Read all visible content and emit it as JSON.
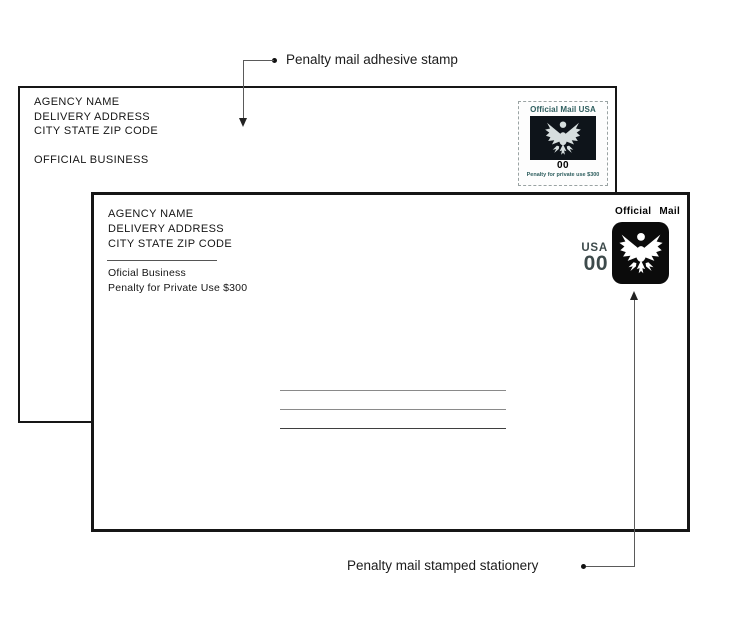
{
  "labels": {
    "top": "Penalty mail adhesive stamp",
    "bottom": "Penalty mail stamped stationery"
  },
  "envelope_top": {
    "address_lines": [
      "AGENCY NAME",
      "DELIVERY ADDRESS",
      "CITY STATE ZIP CODE"
    ],
    "official_business": "OFFICIAL BUSINESS",
    "stamp": {
      "header": "Official Mail USA",
      "denomination": "00",
      "penalty_text": "Penalty for private use $300",
      "colors": {
        "header_text": "#2e5e5e",
        "eagle_panel": "#0e141a",
        "eagle": "#d6dede",
        "denomination": "#000000"
      }
    }
  },
  "envelope_bottom": {
    "address_lines": [
      "AGENCY NAME",
      "DELIVERY ADDRESS",
      "CITY STATE ZIP CODE"
    ],
    "official_business": "Oficial Business",
    "penalty_line": "Penalty for Private Use $300",
    "recipient_line_count": 3,
    "stamp": {
      "header": "Official Mail",
      "country": "USA",
      "denomination": "00",
      "colors": {
        "square": "#0b0b0b",
        "eagle": "#ffffff",
        "value_text": "#3d4a4b"
      }
    }
  }
}
